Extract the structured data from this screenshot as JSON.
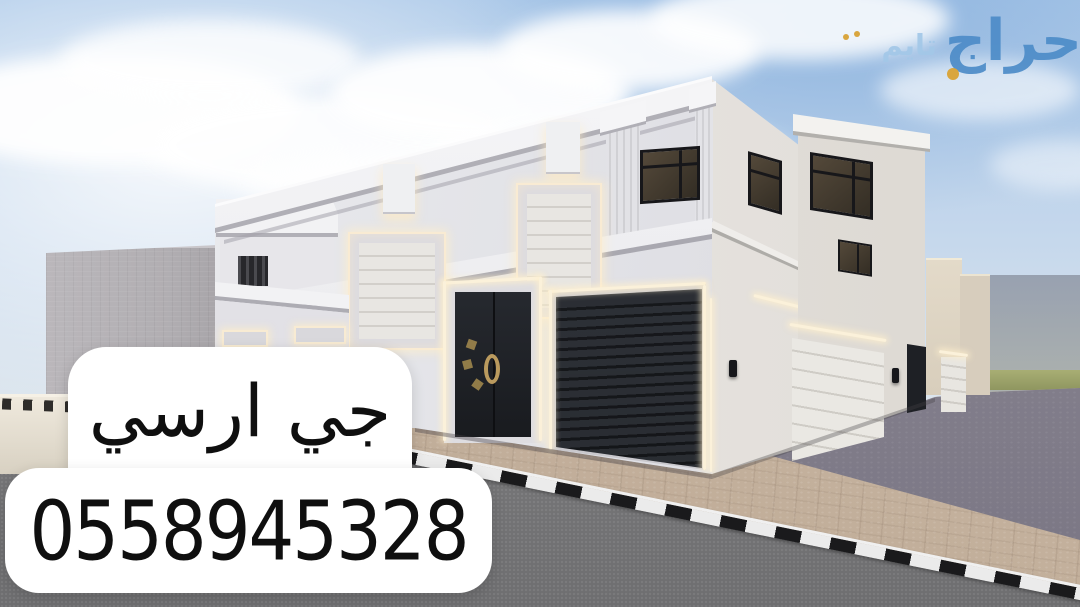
{
  "meta": {
    "type": "real-estate-exterior-render-advertisement",
    "canvas": {
      "width": 1080,
      "height": 607
    }
  },
  "watermark": {
    "word_primary": "حراج",
    "word_secondary": "تايم",
    "color_primary": "#4d8cc8",
    "color_secondary": "#a3c8e8",
    "accent_color": "#d9a63f"
  },
  "overlay": {
    "line1": "جي ارسي",
    "phone": "0558945328",
    "background": "#ffffff",
    "text_color": "#0f0f0f"
  },
  "scene": {
    "description": "Corner view 3D render of a white neo-classical two-storey villa with cornices, warm LED-framed openings, black entrance double door, black roller garage door on the front facade, white sectional garage doors on the side street, interlock brick driveway, black-and-white painted curb, grey asphalt road in the foreground, neighbouring grey block building and beige boundary wall on the left, hazy horizon with a green field strip on the right",
    "palette": {
      "sky_top": "#a9c7e8",
      "sky_horizon": "#e6e9ec",
      "cloud": "#ffffff",
      "wall_light": "#eceef1",
      "wall_shaded": "#d8d8de",
      "cornice": "#f4f4f6",
      "dark_door": "#23262b",
      "roller_garage": "#2c3036",
      "window_glass": "#3b342b",
      "led_glow": "#fbf1da",
      "white_garage": "#e9e7e2",
      "paving": "#c9b7a3",
      "paving_shadow": "#8a8694",
      "asphalt": "#7d7d7f",
      "curb_black": "#1a1a1c",
      "curb_white": "#ebebeb",
      "grey_building": "#b3b0b4",
      "beige_wall": "#e7e0d3",
      "green_strip": "#9aa266"
    }
  }
}
